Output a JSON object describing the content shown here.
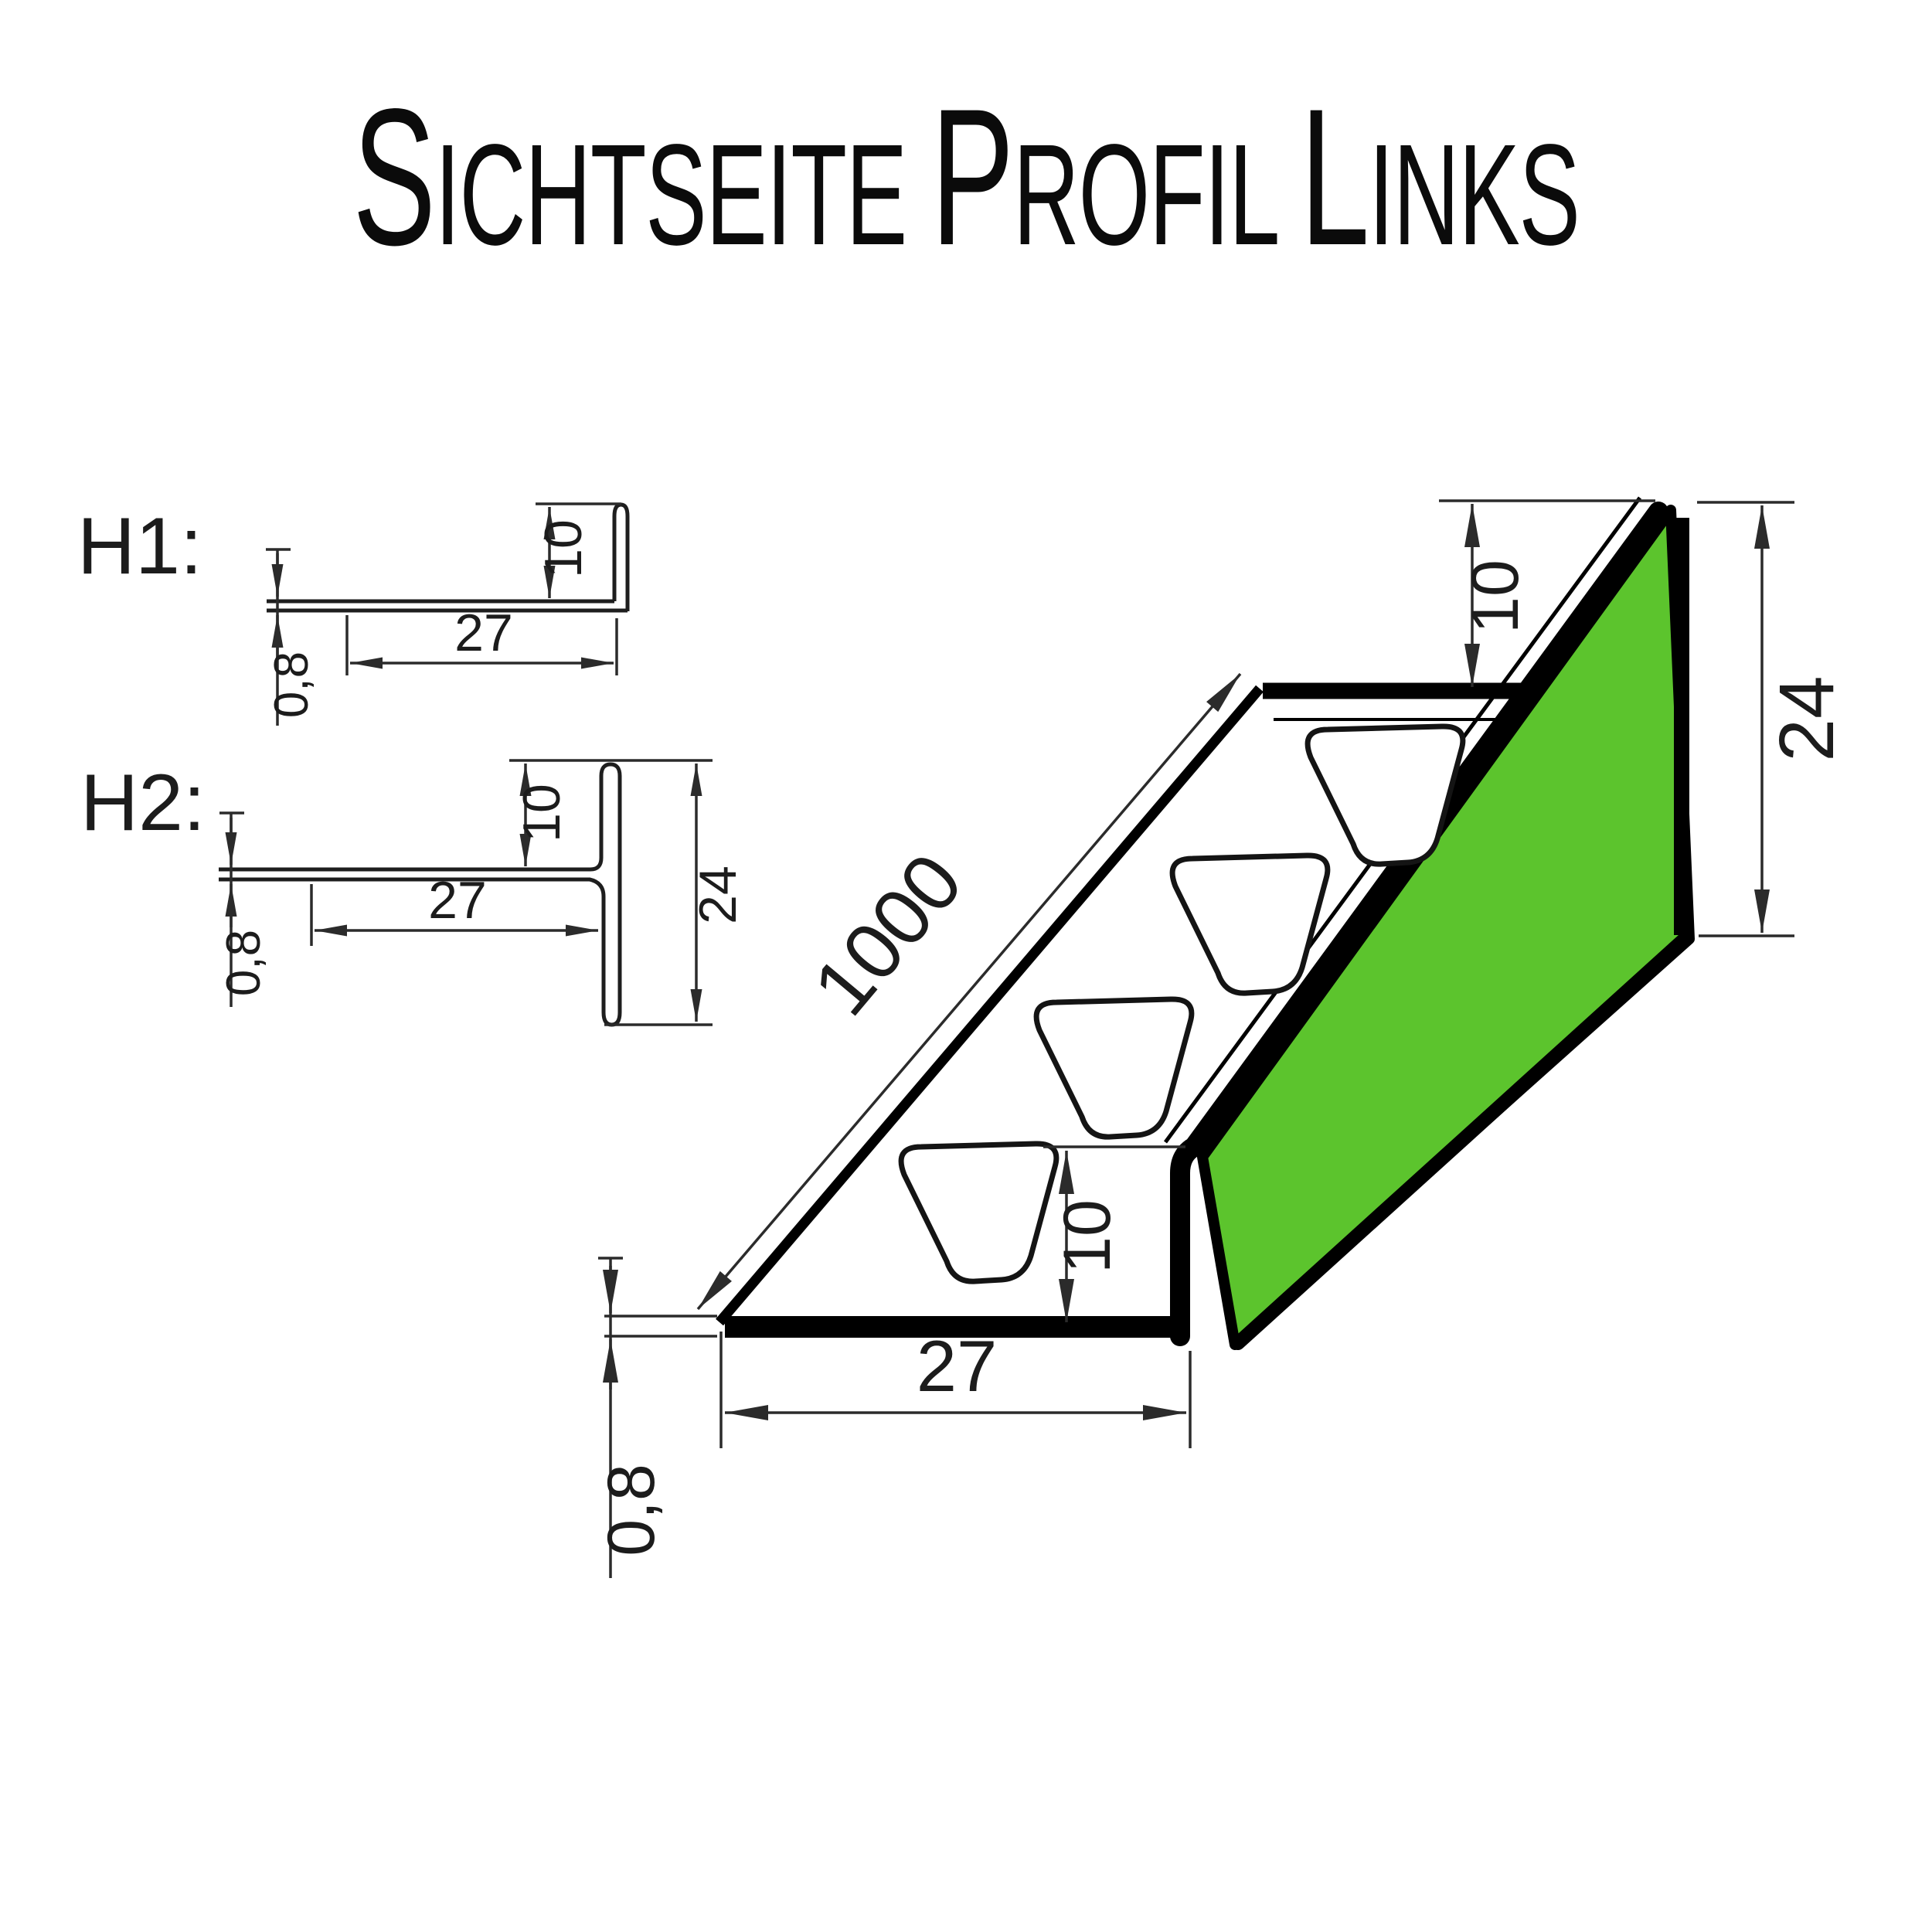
{
  "title": {
    "full": "Sichtseite Profil Links",
    "parts": {
      "p0": "S",
      "p1": "ichtseite ",
      "p2": "P",
      "p3": "rofil ",
      "p4": "L",
      "p5": "inks"
    }
  },
  "colors": {
    "face_green": "#5CC42D",
    "outline": "#000000",
    "dimension": "#2b2b2b"
  },
  "sections": {
    "h1": {
      "label": "H1:",
      "dims": {
        "upstand": "10",
        "width": "27",
        "thickness": "0,8"
      }
    },
    "h2": {
      "label": "H2:",
      "dims": {
        "upstand": "10",
        "width": "27",
        "height": "24",
        "thickness": "0,8"
      }
    },
    "iso": {
      "dims": {
        "length": "1000",
        "upstand": "10",
        "height": "24",
        "width": "27",
        "thickness": "0,8"
      }
    }
  }
}
